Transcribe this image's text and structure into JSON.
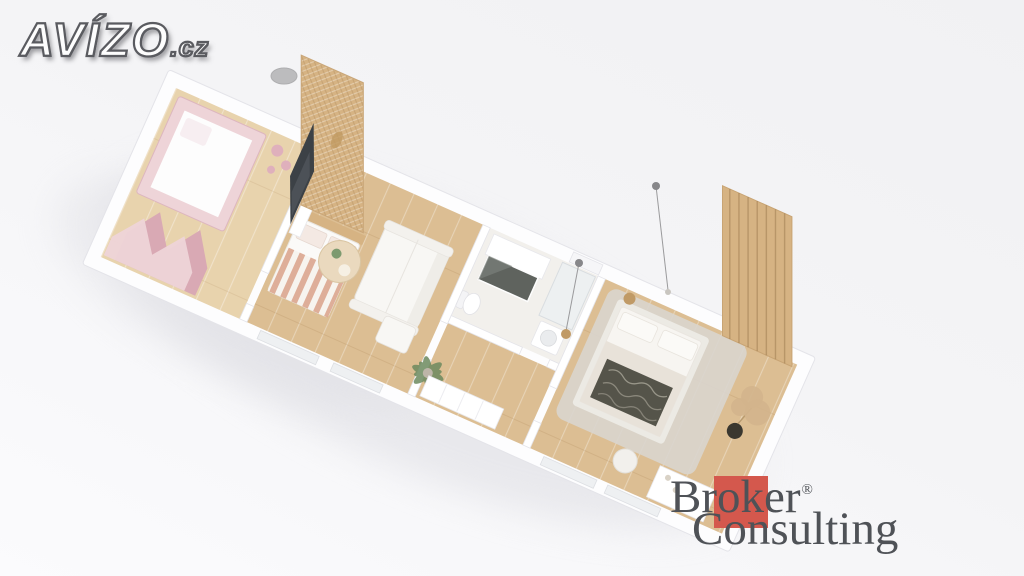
{
  "logos": {
    "avizo": {
      "text": "AVÍZO",
      "suffix": ".cz"
    },
    "broker": {
      "line1": "Broker",
      "registered": "®",
      "line2": "Consulting"
    }
  },
  "scene": {
    "type": "3d-floor-plan-render",
    "colors": {
      "bg-top": "#f1f1f3",
      "bg-bottom": "#fbfbfd",
      "shadow": "#dfdfe4",
      "floor-wood": "#dcbe93",
      "floor-wood-light": "#e8d3ad",
      "bath-floor": "#f2f0ec",
      "wall-white": "#ffffff",
      "wall-edge": "#e4e4e9",
      "pink-light": "#eed4d8",
      "pink-dark": "#d9a9b4",
      "rattan": "#d6b383",
      "tv-dark": "#3c4146",
      "sofa-white": "#f8f7f4",
      "rug-gray": "#d9d5ce",
      "throw-dark": "#55544a",
      "plant-green": "#6d8a5f",
      "pampas-tan": "#d2b48c",
      "broker-red": "#d4584d",
      "broker-gray": "#4f5257"
    },
    "elements": [
      "kids-canopy-bed",
      "zigzag-wall-decor",
      "shelf-decor-dots",
      "rattan-wardrobe",
      "single-bed-striped",
      "gray-ottoman",
      "tv",
      "media-console",
      "sofa",
      "round-coffee-table",
      "palm-plant",
      "bathroom-vanity",
      "dark-mirror",
      "shower",
      "toilet",
      "washing-machine",
      "hall-wardrobe",
      "double-bed",
      "area-rug",
      "dark-throw-blanket",
      "pampas-grass",
      "round-stool",
      "wood-slat-wall",
      "entry-closet",
      "pendant-lights",
      "windows"
    ]
  }
}
